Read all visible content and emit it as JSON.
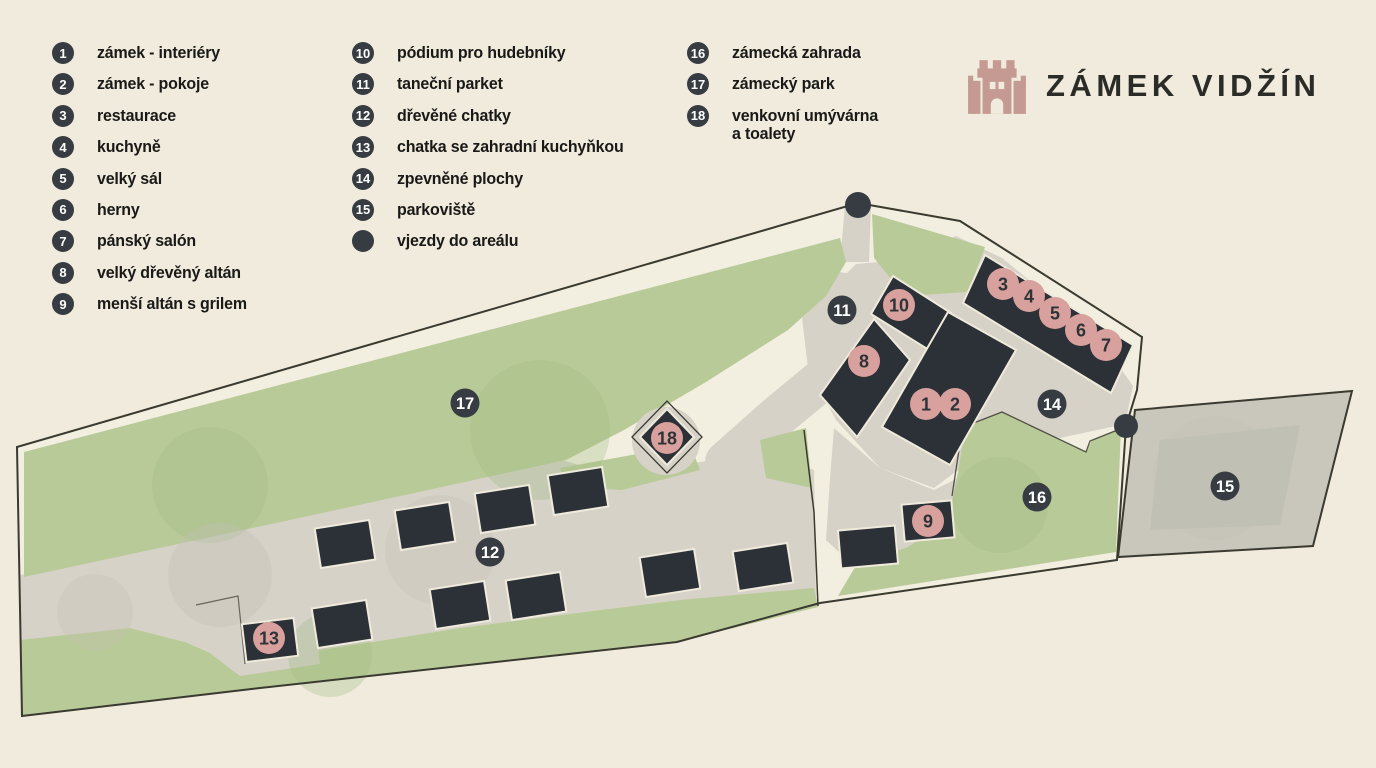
{
  "logo": {
    "title": "ZÁMEK VIDŽÍN",
    "icon": "castle-icon",
    "icon_color": "#c59a93",
    "title_color": "#2b2b28"
  },
  "legend": {
    "columns": [
      {
        "items": [
          {
            "num": "1",
            "label": "zámek - interiéry"
          },
          {
            "num": "2",
            "label": "zámek - pokoje"
          },
          {
            "num": "3",
            "label": "restaurace"
          },
          {
            "num": "4",
            "label": "kuchyně"
          },
          {
            "num": "5",
            "label": "velký sál"
          },
          {
            "num": "6",
            "label": "herny"
          },
          {
            "num": "7",
            "label": "pánský salón"
          },
          {
            "num": "8",
            "label": "velký dřevěný altán"
          },
          {
            "num": "9",
            "label": "menší altán s grilem"
          }
        ]
      },
      {
        "items": [
          {
            "num": "10",
            "label": "pódium pro hudebníky"
          },
          {
            "num": "11",
            "label": "taneční parket"
          },
          {
            "num": "12",
            "label": "dřevěné chatky"
          },
          {
            "num": "13",
            "label": "chatka se zahradní kuchyňkou"
          },
          {
            "num": "14",
            "label": "zpevněné plochy"
          },
          {
            "num": "15",
            "label": "parkoviště"
          },
          {
            "num": "",
            "label": "vjezdy do areálu",
            "marker": "entry-dot"
          }
        ]
      },
      {
        "items": [
          {
            "num": "16",
            "label": "zámecká zahrada"
          },
          {
            "num": "17",
            "label": "zámecký park"
          },
          {
            "num": "18",
            "label": "venkovní umývárna",
            "label2": "a toalety"
          }
        ]
      }
    ]
  },
  "map": {
    "markers": [
      {
        "num": "1",
        "x": 926,
        "y": 404,
        "style": "pink"
      },
      {
        "num": "2",
        "x": 955,
        "y": 404,
        "style": "pink"
      },
      {
        "num": "3",
        "x": 1003,
        "y": 284,
        "style": "pink"
      },
      {
        "num": "4",
        "x": 1029,
        "y": 296,
        "style": "pink"
      },
      {
        "num": "5",
        "x": 1055,
        "y": 313,
        "style": "pink"
      },
      {
        "num": "6",
        "x": 1081,
        "y": 330,
        "style": "pink"
      },
      {
        "num": "7",
        "x": 1106,
        "y": 345,
        "style": "pink"
      },
      {
        "num": "8",
        "x": 864,
        "y": 361,
        "style": "pink"
      },
      {
        "num": "9",
        "x": 928,
        "y": 521,
        "style": "pink"
      },
      {
        "num": "10",
        "x": 899,
        "y": 305,
        "style": "pink"
      },
      {
        "num": "13",
        "x": 269,
        "y": 638,
        "style": "pink"
      },
      {
        "num": "18",
        "x": 667,
        "y": 438,
        "style": "pink"
      },
      {
        "num": "11",
        "x": 842,
        "y": 310,
        "style": "dark"
      },
      {
        "num": "12",
        "x": 490,
        "y": 552,
        "style": "dark"
      },
      {
        "num": "14",
        "x": 1052,
        "y": 404,
        "style": "dark"
      },
      {
        "num": "15",
        "x": 1225,
        "y": 486,
        "style": "dark"
      },
      {
        "num": "16",
        "x": 1037,
        "y": 497,
        "style": "dark"
      },
      {
        "num": "17",
        "x": 465,
        "y": 403,
        "style": "dark"
      }
    ],
    "entry_points": [
      {
        "x": 858,
        "y": 205,
        "r": 13
      },
      {
        "x": 1126,
        "y": 426,
        "r": 12
      }
    ],
    "colors": {
      "bg": "#f0ebdc",
      "parcel": "#f3efe0",
      "grass": "#b9ca99",
      "grass_dark": "#9cb97e",
      "path": "#d6d2c8",
      "path_dark": "#c2bfb4",
      "parking": "#c9c6bc",
      "building": "#2b3136",
      "outline": "#3a3a31",
      "dark_marker": "#363c41",
      "pink_marker": "#d8a19d",
      "pink_marker_text": "#2e3338"
    }
  }
}
